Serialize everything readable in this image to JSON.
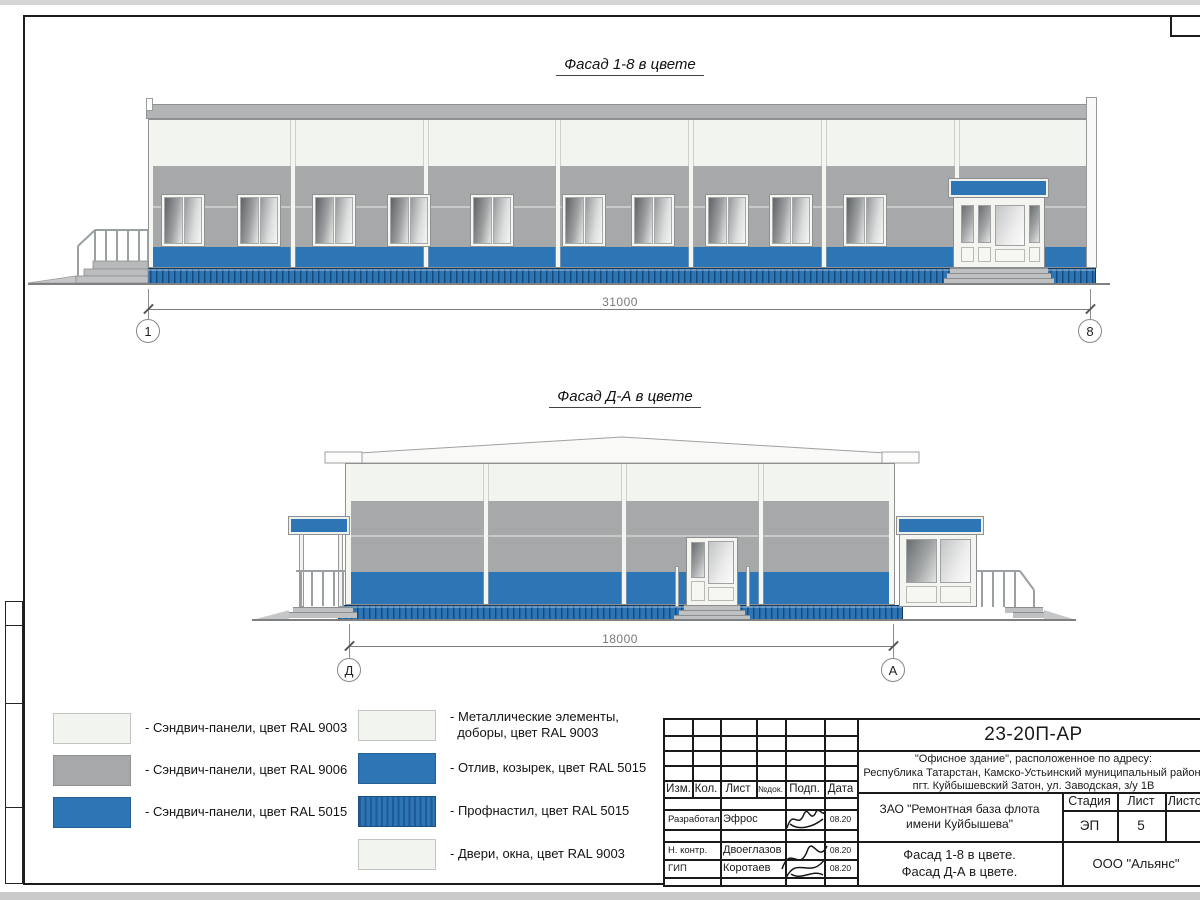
{
  "sheet": {
    "facade1": {
      "title": "Фасад 1-8 в цвете",
      "dimension": "31000",
      "axis_left": "1",
      "axis_right": "8"
    },
    "facade2": {
      "title": "Фасад Д-А в цвете",
      "dimension": "18000",
      "axis_left": "Д",
      "axis_right": "А"
    }
  },
  "colors": {
    "ral9003": "#f2f4ef",
    "ral9006": "#a6a8aa",
    "ral5015": "#2e75b6",
    "ral5015_dark": "#1f5c97"
  },
  "legend": {
    "left": [
      {
        "label": "- Сэндвич-панели, цвет RAL 9003",
        "swatch": "ral9003"
      },
      {
        "label": "- Сэндвич-панели, цвет RAL 9006",
        "swatch": "ral9006"
      },
      {
        "label": "- Сэндвич-панели, цвет RAL 5015",
        "swatch": "ral5015"
      }
    ],
    "right": [
      {
        "label": "- Металлические элементы,\n  доборы, цвет RAL 9003",
        "swatch": "ral9003"
      },
      {
        "label": "- Отлив, козырек, цвет RAL 5015",
        "swatch": "ral5015"
      },
      {
        "label": "- Профнастил, цвет RAL 5015",
        "swatch": "ral5015_striped"
      },
      {
        "label": "- Двери, окна, цвет RAL 9003",
        "swatch": "ral9003"
      }
    ]
  },
  "titleblock": {
    "doc_number": "23-20П-АР",
    "address_line1": "\"Офисное здание\", расположенное по адресу:",
    "address_line2": "Республика Татарстан, Камско-Устьинский муниципальный район,",
    "address_line3": "пгт. Куйбышевский Затон, ул. Заводская, з/у 1В",
    "header_cols": [
      "Изм.",
      "Кол.",
      "Лист",
      "№док.",
      "Подп.",
      "Дата"
    ],
    "rows": [
      {
        "role": "Разработал",
        "name": "Эфрос",
        "date": "08.20"
      },
      {
        "role": "Н. контр.",
        "name": "Двоеглазов",
        "date": "08.20"
      },
      {
        "role": "ГИП",
        "name": "Коротаев",
        "date": "08.20"
      }
    ],
    "client_line1": "ЗАО \"Ремонтная база флота",
    "client_line2": "имени Куйбышева\"",
    "stage_label": "Стадия",
    "sheet_label": "Лист",
    "sheets_label": "Листов",
    "stage_value": "ЭП",
    "sheet_value": "5",
    "title_line1": "Фасад 1-8 в цвете.",
    "title_line2": "Фасад Д-А в цвете.",
    "company": "ООО \"Альянс\""
  }
}
